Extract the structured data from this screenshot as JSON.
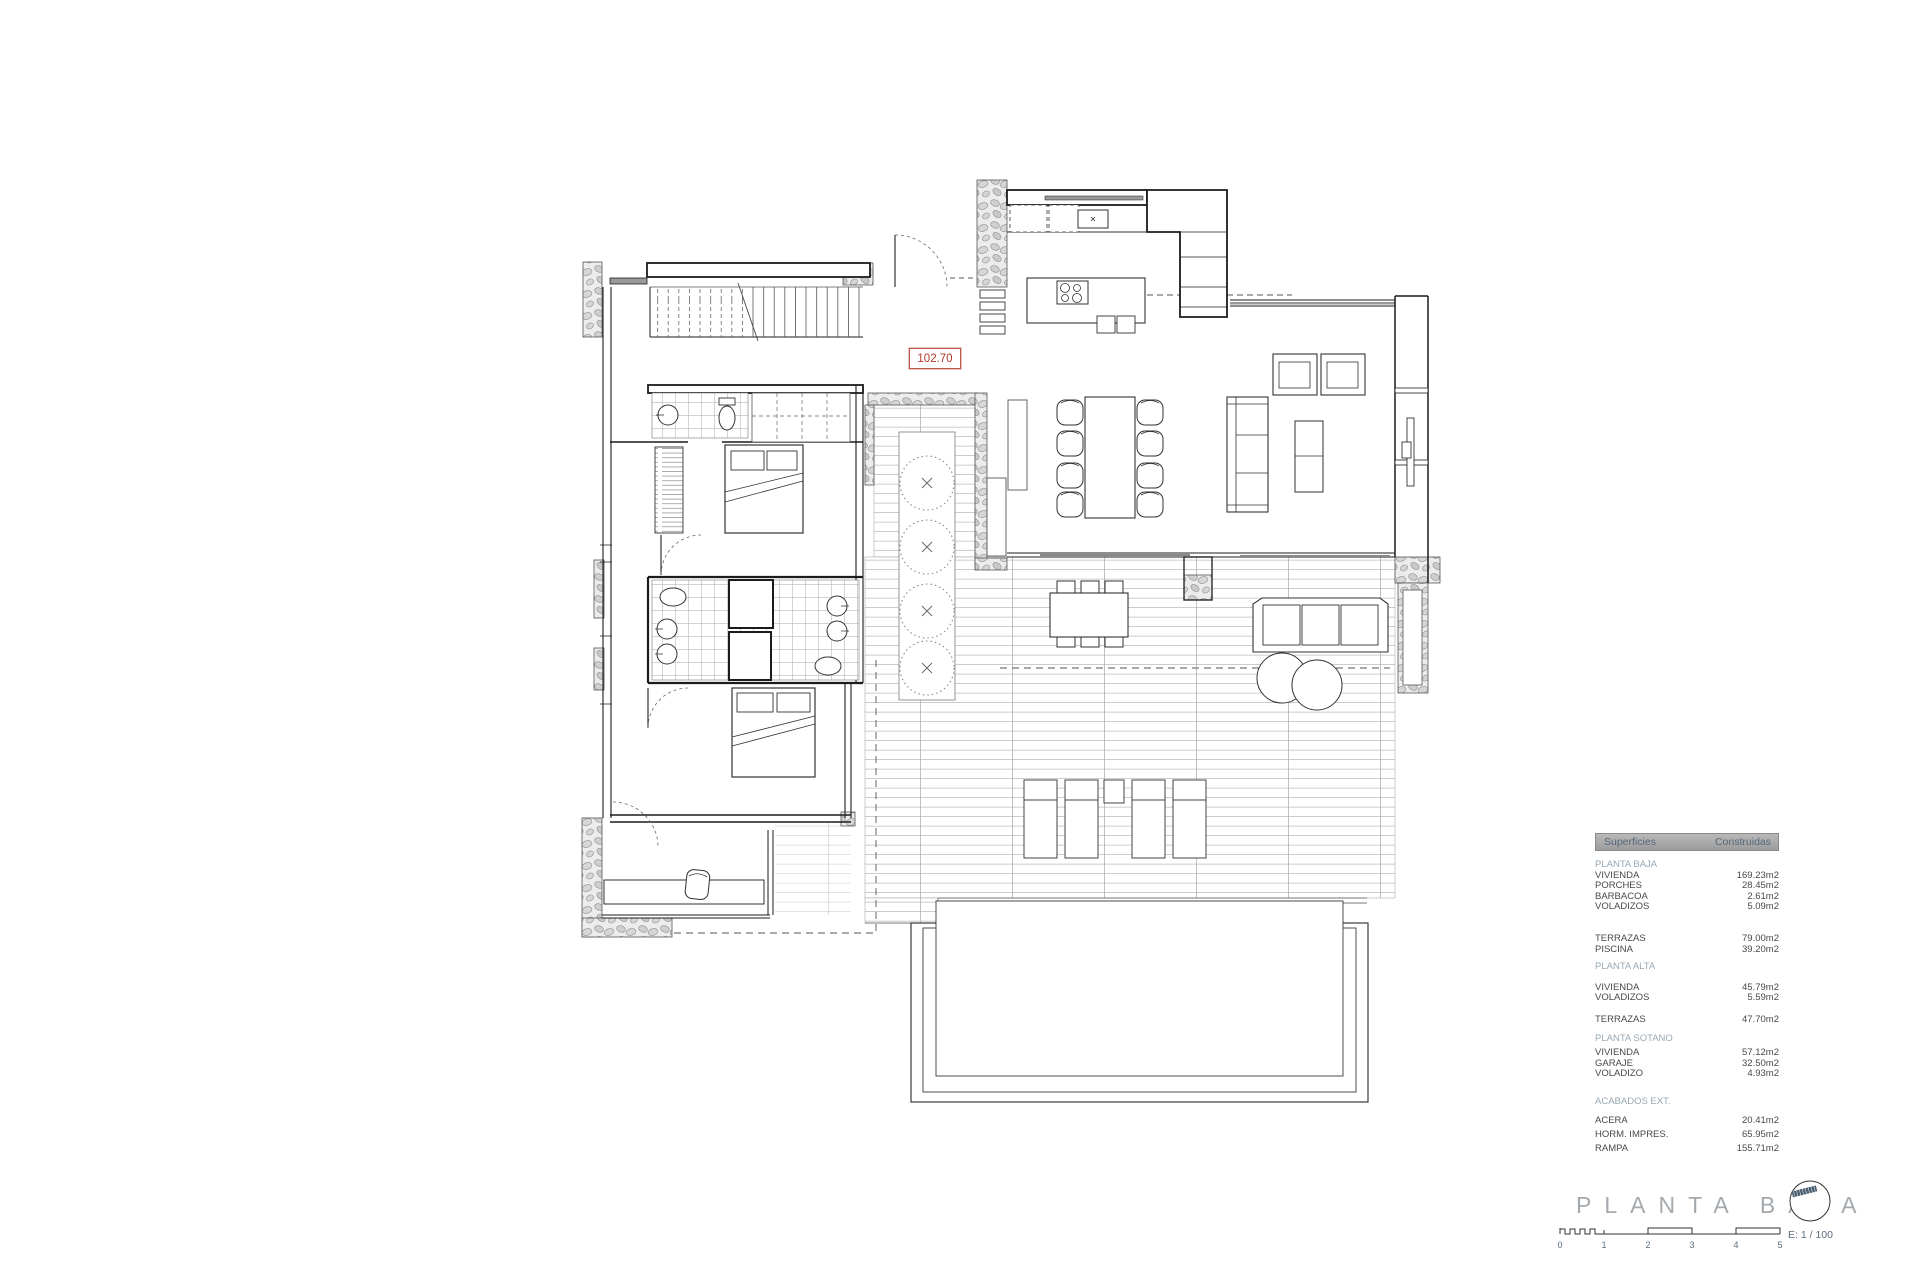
{
  "plan": {
    "level_label": "102.70"
  },
  "legend": {
    "header": {
      "col1": "Superficies",
      "col2": "Construidas"
    },
    "sections": [
      {
        "heading": "PLANTA BAJA",
        "rows": [
          [
            "VIVIENDA",
            "169.23m2"
          ],
          [
            "PORCHES",
            "28.45m2"
          ],
          [
            "BARBACOA",
            "2.61m2"
          ],
          [
            "VOLADIZOS",
            "5.09m2"
          ]
        ]
      },
      {
        "heading": "",
        "rows": [
          [
            "TERRAZAS",
            "79.00m2"
          ],
          [
            "PISCINA",
            "39.20m2"
          ]
        ]
      },
      {
        "heading": "PLANTA ALTA",
        "rows": [
          [
            "VIVIENDA",
            "45.79m2"
          ],
          [
            "VOLADIZOS",
            "5.59m2"
          ]
        ]
      },
      {
        "heading": "",
        "rows": [
          [
            "TERRAZAS",
            "47.70m2"
          ]
        ]
      },
      {
        "heading": "PLANTA SOTANO",
        "rows": [
          [
            "VIVIENDA",
            "57.12m2"
          ],
          [
            "GARAJE",
            "32.50m2"
          ],
          [
            "VOLADIZO",
            "4.93m2"
          ]
        ]
      },
      {
        "heading": "ACABADOS EXT.",
        "rows": [
          [
            "ACERA",
            "20.41m2"
          ],
          [
            "HORM. IMPRES.",
            "65.95m2"
          ],
          [
            "RAMPA",
            "155.71m2"
          ]
        ]
      }
    ]
  },
  "title": {
    "text": "PLANTA BAJA",
    "scale_label": "E: 1 / 100",
    "scale_ticks": [
      "0",
      "1",
      "2",
      "3",
      "4",
      "5"
    ]
  },
  "colors": {
    "accent_red": "#b5352c",
    "legend_header_bg": "#a8a8a8",
    "section_heading": "#98a9b5",
    "body_text": "#45494d",
    "title_gray": "#a3a9ad",
    "wall_line": "#1c1c1c"
  }
}
